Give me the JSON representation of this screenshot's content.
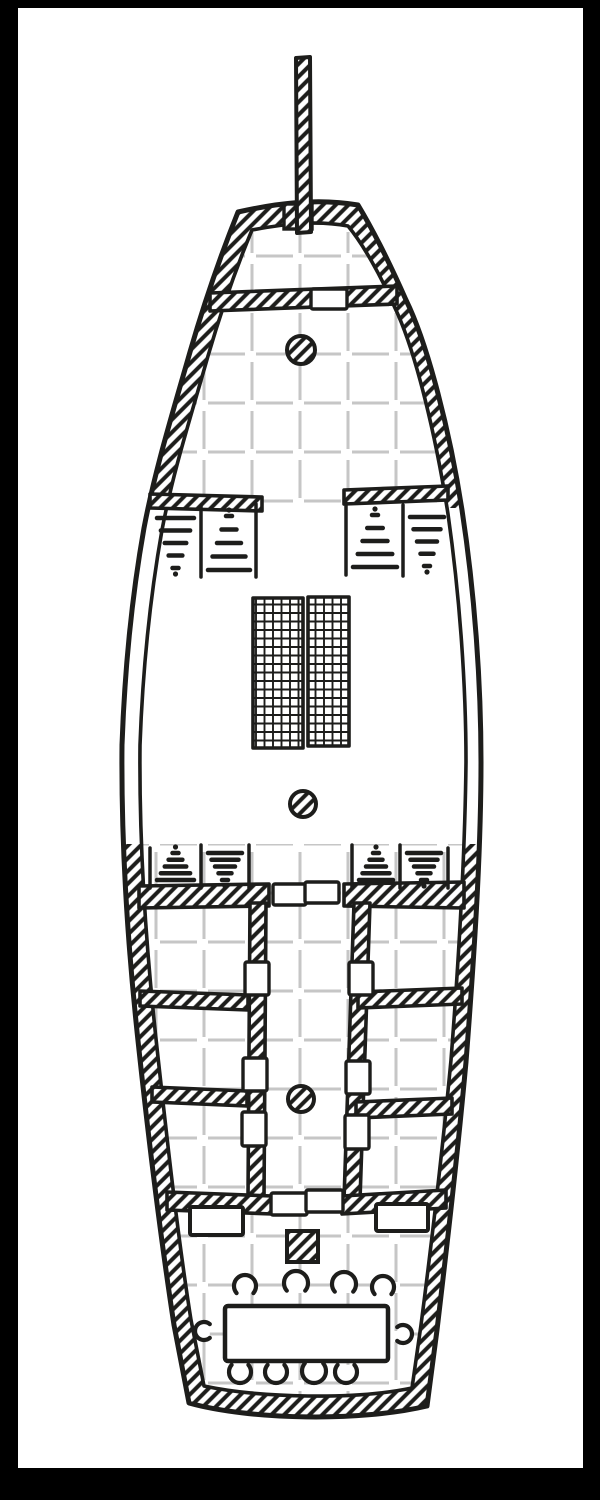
{
  "meta": {
    "title": "Hand-drawn top-down deck plan of a sailing ship with grid overlay",
    "style": "black ink line art on white paper, diagonal hatching for solid walls"
  },
  "colors": {
    "ink": "#1d1d1b",
    "paper": "#ffffff",
    "grid_line": "#c6c6c6",
    "frame": "#000000"
  },
  "frame": {
    "top_px": 8,
    "bottom_px": 32,
    "left_px": 18,
    "right_px": 17
  },
  "grid": {
    "vertical": {
      "start": 156,
      "step": 48,
      "count": 7,
      "y1": 232,
      "y2": 1396,
      "dash": "38 11",
      "offset": 17
    },
    "horizontal": {
      "start": 256,
      "step": 49,
      "count": 25,
      "x1": 128,
      "x2": 472,
      "dash": "37 11",
      "offset": 16
    },
    "stroke_width": 3
  },
  "bowsprit": {
    "name": "bowsprit",
    "pole_points": "296,58 310,57 311,232 297,233",
    "foot": {
      "x": 284,
      "y": 204,
      "w": 28,
      "h": 25
    }
  },
  "masts": [
    {
      "name": "foremast",
      "cx": 301,
      "cy": 350,
      "r": 14
    },
    {
      "name": "mainmast",
      "cx": 303,
      "cy": 804,
      "r": 13
    },
    {
      "name": "mizzenmast",
      "cx": 301,
      "cy": 1099,
      "r": 13
    }
  ],
  "cargo_grates": [
    {
      "name": "cargo-grate-left",
      "x": 253,
      "y": 598,
      "w": 50,
      "h": 150
    },
    {
      "name": "cargo-grate-right",
      "x": 308,
      "y": 597,
      "w": 41,
      "h": 149
    }
  ],
  "doors": [
    {
      "name": "bow-door",
      "x": 311,
      "y": 289,
      "w": 36,
      "h": 20
    },
    {
      "name": "aft-bulkhead-door-left",
      "x": 273,
      "y": 884,
      "w": 33,
      "h": 21
    },
    {
      "name": "aft-bulkhead-door-right",
      "x": 305,
      "y": 882,
      "w": 34,
      "h": 21
    },
    {
      "name": "corridor-door-left-1",
      "x": 245,
      "y": 962,
      "w": 24,
      "h": 33
    },
    {
      "name": "corridor-door-left-2",
      "x": 243,
      "y": 1058,
      "w": 24,
      "h": 33
    },
    {
      "name": "corridor-door-left-3",
      "x": 242,
      "y": 1112,
      "w": 24,
      "h": 34
    },
    {
      "name": "corridor-door-right-1",
      "x": 349,
      "y": 962,
      "w": 24,
      "h": 33
    },
    {
      "name": "corridor-door-right-2",
      "x": 346,
      "y": 1061,
      "w": 24,
      "h": 33
    },
    {
      "name": "corridor-door-right-3",
      "x": 345,
      "y": 1115,
      "w": 24,
      "h": 34
    },
    {
      "name": "stern-door-left",
      "x": 271,
      "y": 1193,
      "w": 36,
      "h": 22
    },
    {
      "name": "stern-door-right",
      "x": 306,
      "y": 1190,
      "w": 37,
      "h": 22
    }
  ],
  "stairs": [
    {
      "name": "forecastle-stairs-left",
      "verticals": [
        [
          201,
          506,
          201,
          577
        ],
        [
          256,
          504,
          256,
          577
        ]
      ],
      "bays": [
        {
          "x1": 153,
          "x2": 198,
          "y1": 512,
          "y2": 574,
          "taper": "down"
        },
        {
          "x1": 204,
          "x2": 254,
          "y1": 510,
          "y2": 576,
          "taper": "up"
        }
      ]
    },
    {
      "name": "forecastle-stairs-right",
      "verticals": [
        [
          346,
          503,
          346,
          575
        ],
        [
          403,
          505,
          403,
          576
        ]
      ],
      "bays": [
        {
          "x1": 349,
          "x2": 401,
          "y1": 509,
          "y2": 573,
          "taper": "up"
        },
        {
          "x1": 406,
          "x2": 448,
          "y1": 511,
          "y2": 572,
          "taper": "down"
        }
      ]
    },
    {
      "name": "aft-stairs-left",
      "verticals": [
        [
          150,
          848,
          150,
          888
        ],
        [
          201,
          845,
          201,
          888
        ],
        [
          249,
          845,
          249,
          888
        ]
      ],
      "bays": [
        {
          "x1": 153,
          "x2": 198,
          "y1": 847,
          "y2": 886,
          "taper": "up"
        },
        {
          "x1": 204,
          "x2": 246,
          "y1": 847,
          "y2": 886,
          "taper": "down"
        }
      ]
    },
    {
      "name": "aft-stairs-right",
      "verticals": [
        [
          352,
          845,
          352,
          888
        ],
        [
          400,
          845,
          400,
          888
        ],
        [
          448,
          848,
          448,
          888
        ]
      ],
      "bays": [
        {
          "x1": 355,
          "x2": 397,
          "y1": 847,
          "y2": 886,
          "taper": "up"
        },
        {
          "x1": 403,
          "x2": 445,
          "y1": 847,
          "y2": 886,
          "taper": "down"
        }
      ]
    }
  ],
  "furniture": {
    "lockers": [
      {
        "name": "stern-locker-left",
        "x": 190,
        "y": 1207,
        "w": 53,
        "h": 28
      },
      {
        "name": "stern-locker-right",
        "x": 376,
        "y": 1204,
        "w": 52,
        "h": 27
      }
    ],
    "mast_step": {
      "name": "mizzen-mast-step",
      "x": 287,
      "y": 1231,
      "w": 31,
      "h": 31
    },
    "table": {
      "name": "stern-table",
      "x": 225,
      "y": 1306,
      "w": 163,
      "h": 55
    },
    "chairs": [
      {
        "cx": 245,
        "cy": 1286,
        "r": 11,
        "open": 90
      },
      {
        "cx": 296,
        "cy": 1283,
        "r": 12,
        "open": 90
      },
      {
        "cx": 344,
        "cy": 1284,
        "r": 12,
        "open": 90
      },
      {
        "cx": 383,
        "cy": 1287,
        "r": 11,
        "open": 90
      },
      {
        "cx": 240,
        "cy": 1372,
        "r": 11,
        "open": 270
      },
      {
        "cx": 276,
        "cy": 1372,
        "r": 11,
        "open": 270
      },
      {
        "cx": 314,
        "cy": 1371,
        "r": 12,
        "open": 270
      },
      {
        "cx": 346,
        "cy": 1372,
        "r": 11,
        "open": 270
      },
      {
        "cx": 204,
        "cy": 1331,
        "r": 9,
        "open": 0
      },
      {
        "cx": 403,
        "cy": 1334,
        "r": 9,
        "open": 180
      }
    ]
  }
}
